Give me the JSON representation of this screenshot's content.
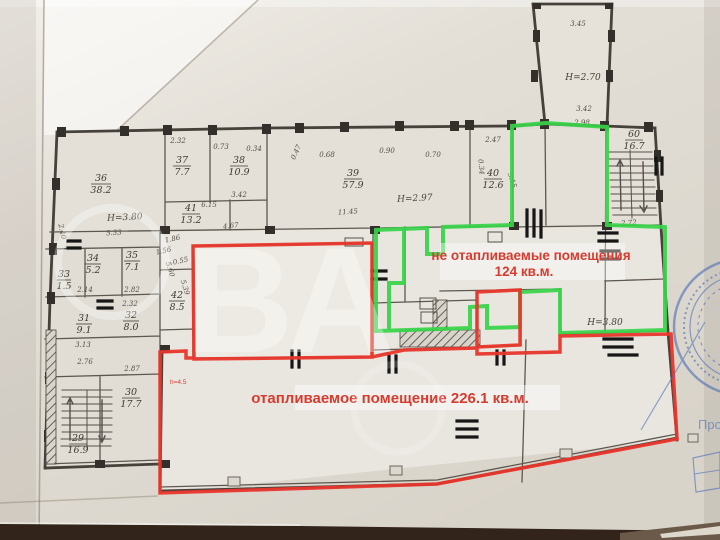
{
  "watermark": {
    "text": "ВА"
  },
  "annotations": {
    "unheated_line1": "не отапливаемые помещения",
    "unheated_line2": "124 кв.м.",
    "heated": "отапливаемое помещение 226.1 кв.м.",
    "height_note": "h=4.5"
  },
  "stamp": {
    "partial_text": "Про"
  },
  "plan": {
    "rooms": [
      {
        "number": "36",
        "area": "38.2"
      },
      {
        "number": "37",
        "area": "7.7"
      },
      {
        "number": "38",
        "area": "10.9"
      },
      {
        "number": "39",
        "area": "57.9"
      },
      {
        "number": "40",
        "area": "12.6"
      },
      {
        "number": "41",
        "area": "13.2"
      },
      {
        "number": "60",
        "area": "16.7"
      },
      {
        "number": "34",
        "area": "5.2"
      },
      {
        "number": "35",
        "area": "7.1"
      },
      {
        "number": "42",
        "area": "8.5"
      },
      {
        "number": "31",
        "area": "9.1"
      },
      {
        "number": "32",
        "area": "8.0"
      },
      {
        "number": "33",
        "area": "1.5"
      },
      {
        "number": "30",
        "area": "17.7"
      },
      {
        "number": "29",
        "area": "16.9"
      }
    ],
    "heights": {
      "left": "Н=3.80",
      "room39": "Н=2.97",
      "corridor": "Н=2.70",
      "right": "Н=3.80"
    },
    "dims": [
      "2.32",
      "0.73",
      "0.34",
      "3.42",
      "6.15",
      "4.67",
      "0.47",
      "0.68",
      "0.90",
      "0.70",
      "2.47",
      "0.34",
      "5.15",
      "11.45",
      "3.45",
      "3.42",
      "2.98",
      "2.72",
      "5.33",
      "2.40",
      "2.14",
      "2.82",
      "2.32",
      "3.13",
      "2.76",
      "2.87",
      "5.60",
      "5.39",
      "1.86",
      "1.56",
      "0.55"
    ]
  },
  "colors": {
    "heated_outline": "#e8372c",
    "unheated_outline": "#38d44a",
    "annotation_text": "#d93a2e",
    "stamp_blue": "#4a6db8",
    "pencil": "#46413a",
    "paper": "#ddd8cf"
  }
}
